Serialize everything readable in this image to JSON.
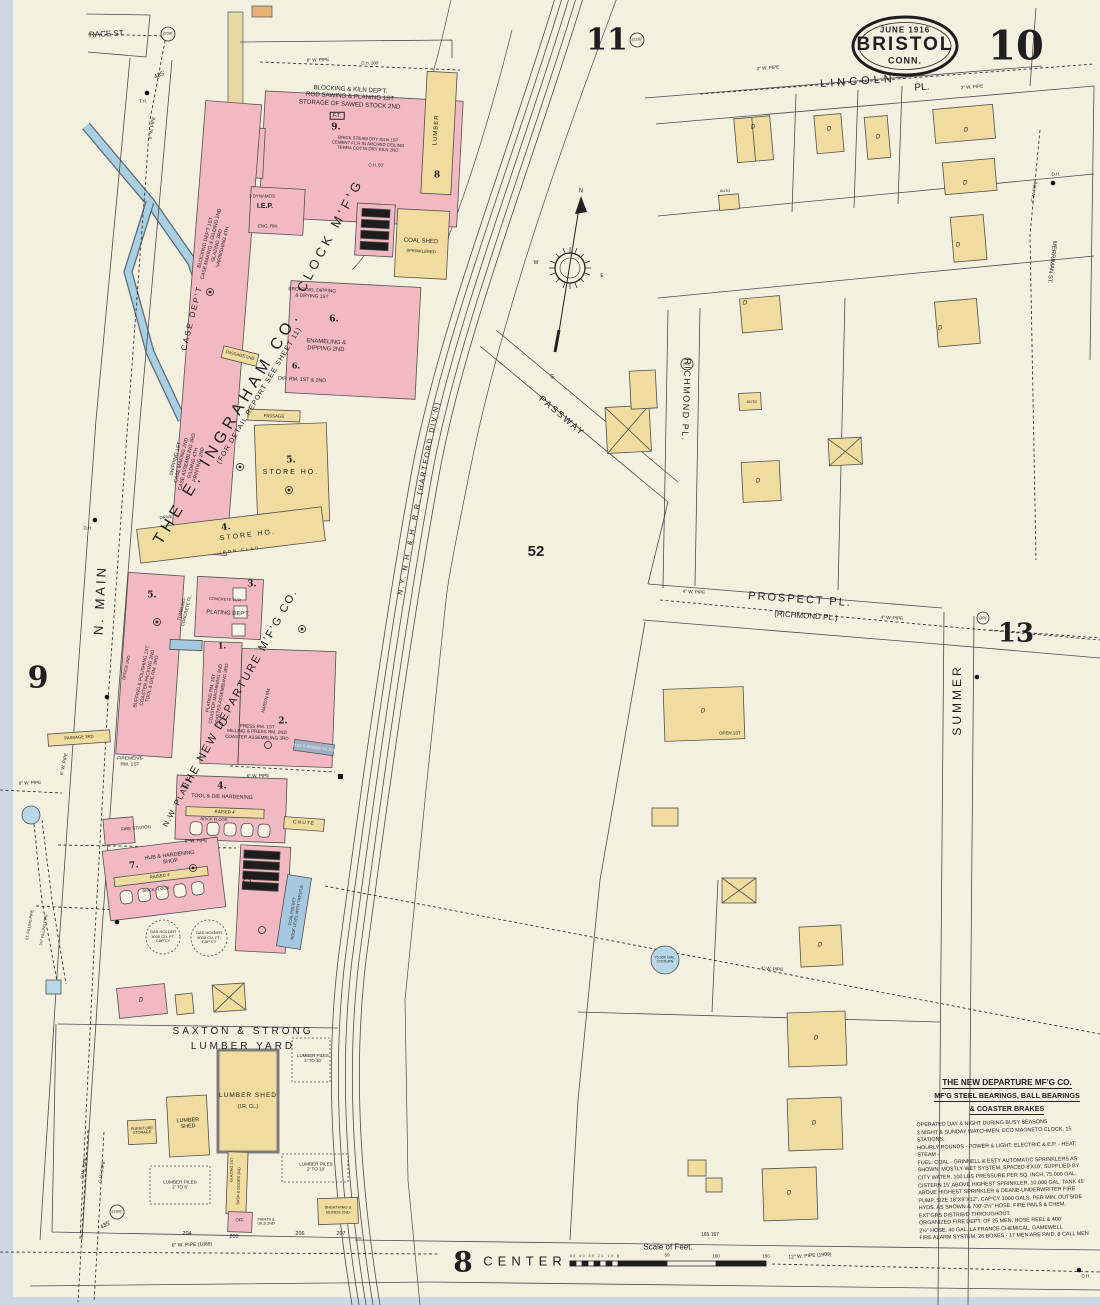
{
  "page": {
    "sheet_number": "10",
    "adjacent_top": "11",
    "adjacent_left": "9",
    "adjacent_right": "13",
    "adjacent_bottom": "8",
    "title_date": "JUNE 1916",
    "title_city": "BRISTOL",
    "title_state": "CONN.",
    "block_number": "52"
  },
  "streets": {
    "race": "RACE ST.",
    "n_main": "N. MAIN",
    "lincoln": "LINCOLN",
    "lincoln_pl": "PL.",
    "richmond": "RICHMOND PL.",
    "prospect": "PROSPECT PL.",
    "prospect_alt": "(RICHMOND PL.)",
    "summer": "SUMMER",
    "passway": "PASSWAY",
    "center": "CENTER",
    "merriman": "MERRIMAN ST.",
    "railroad": "N.Y. N.H. & H. R.R. (HARTFORD DIV'N)"
  },
  "ingraham": {
    "company": "THE E. INGRAHAM CO.",
    "company_sub": "(FOR DETAIL REPORT SEE SHEET 11)",
    "clock_mfg": "CLOCK M'F'G",
    "blocking_kiln": "BLOCKING & KILN DEP'T.\nROD SAWING & PLANING 1ST\nSTORAGE OF SAWED STOCK 2ND",
    "ft": "F.T.",
    "num_9": "9.",
    "kiln_note": "BRICK STEAM DRY KILN 1ST\nCEMENT FL'R IN ARCHED CEILING\nTERRA COTTA DRY KILN 2ND",
    "case_dept": "CASE DEP'T",
    "blocking_stack": "BLOCKING DEP'T 1ST\nCASE MAKING & GILDING 2ND\nGLAZING 3RD\nVARNISHING 4TH",
    "shipping_stack": "SHIPPING 1ST\nCASE MAKING 2ND\nCASE ASSEMBLING 3RD\nGILDING 4TH\nPRINTING 2ND",
    "dynamos": "3 DYNAMOS",
    "iep": "I.E.P.",
    "eng_rm": "ENG. RM.",
    "bronzing": "BRONZING, DIPPING\n& DRYING 1ST",
    "enameling": "ENAMELING &\nDIPPING 2ND",
    "dip_rm": "DIP. RM. 1ST & 2ND",
    "num_6a": "6.",
    "num_6b": "6.",
    "coal_shed": "COAL SHED",
    "sprinklered": "SPRINKLERED",
    "lumber": "LUMBER",
    "num_8": "8",
    "passage": "PASSAGE",
    "passage_2": "PASSAGE 2ND",
    "passage_3": "PASSAGE 3RD",
    "store5_num": "5.",
    "store5": "STORE HO.",
    "store4_num": "4.",
    "store4": "STORE HO.",
    "iron_clad": "IRON CLAD",
    "drive": "DRIVE"
  },
  "departure": {
    "company": "THE NEW DEPARTURE M'F'G CO.",
    "plant": "N.W. PLANT",
    "num_5": "5.",
    "buffing_stack": "BUFFING & POLISHING 1ST\nCOASTER PACKING 2ND\nTOOL & DIE RM. 3RD",
    "office": "OFFICE 2ND",
    "firemens": "FIREMEN'S\nRM. 1ST",
    "num_3": "3.",
    "plating_dept": "PLATING DEP'T.",
    "concrete": "CONCRETE FL'R",
    "tumbling": "TUMBLING\nCONCRETE FL.",
    "num_1": "1.",
    "plating_stack": "PLATING RM. 1ST\nCOASTER MACHINING 2ND\nCOASTER ASSEMBLING 3RD",
    "num_2": "2.",
    "press_stack": "PRESS RM. 1ST\nMILLING & PRESS RM. 2ND\nCOASTER ASSEMBLING 3RD",
    "hardn": "HARD'N RM.",
    "bridge": "ELEV'D BRIDGE TO 2ND",
    "num_4": "4.",
    "tool_die": "TOOL & DIE HARDENING",
    "raised_a": "RAISED 4'",
    "brick_a": "BRICK FLOOR",
    "num_7": "7.",
    "hub": "HUB & HARDENING\nSHOP",
    "raised_b": "RAISED 4'",
    "brick_b": "BRICK FLOOR",
    "chute": "CHUTE",
    "coal_pocket": "COAL POCKET\nROOF LEVEL WITH TRESTLE",
    "fire_station": "FIRE STATION",
    "gas_1": "GAS HOLDER\n3000 CU. FT.\nCAP'CY",
    "gas_2": "GAS HOLDER\n5000 CU. FT.\nCAP'CY",
    "cistern": "75,000 GAL.\nCISTERN"
  },
  "yard": {
    "name_1": "SAXTON  &  STRONG",
    "name_2": "LUMBER   YARD",
    "shed_big": "LUMBER SHED",
    "shed_big_sub": "(I.R. CL.)",
    "shed_small": "LUMBER\nSHED",
    "furniture": "FURNITURE\nSTORAGE",
    "piles_a": "LUMBER PILES\n2' TO 10'",
    "piles_b": "LUMBER PILES\n2' TO 10'",
    "piles_c": "LUMBER PILES\n2' TO 6'",
    "sash": "SASH & DOORS 2ND",
    "glazing": "GLAZING 1ST",
    "office": "OFF.",
    "paints": "PAINTS &\nOILS 2ND",
    "sheathing": "SHEATHING &\nBLINDS 2ND"
  },
  "residential": {
    "dwelling": "D",
    "auto": "AUTO",
    "open": "OPEN 1ST"
  },
  "pipes": {
    "w8": "8\" W. PIPE",
    "w6_top": "6\" W. PIPE",
    "w2_a": "2\" W. PIPE",
    "w2_b": "2\" W. PIPE",
    "w4_mer": "4\" W. PIPE",
    "w4_pros_w": "4\" W. PIPE",
    "w4_pros_e": "4\" W. PIPE",
    "w6_main": "6\" W. PIPE",
    "w6_cross": "6\" W. PIPE",
    "w6_hub": "6\" W. PIPE",
    "w6_b2": "6\" W. PIPE",
    "w4_diag": "4\" W. PIPE",
    "gw_a": "G.W. PIPE",
    "gw_b": "G.W. PIPE",
    "w6_1889": "6\" W. PIPE (1889)",
    "w12_1909": "12\" W. PIPE (1909)",
    "fill_a": "ST. FILLING PIPE",
    "fill_b": "3½\" FILLING PIPE"
  },
  "marks": {
    "d200": "(200)'",
    "d228": "(228)'",
    "d30_a": "(30)'",
    "d30_b": "(30)'",
    "d180": "(180)'",
    "d435_a": "435'",
    "d435_b": "435'",
    "n204": "204",
    "n205": "205",
    "n206": "206",
    "n207": "207",
    "n165": "165   167",
    "th": "T.H.",
    "dh_a": "D.H.",
    "dh_b": "D.H.",
    "dh_c": "D.H.",
    "oh200": "O.H. 200'",
    "oh50": "O.H. 50'"
  },
  "note": {
    "title_1": "THE NEW DEPARTURE MF'G CO.",
    "title_2": "MF'G STEEL BEARINGS, BALL BEARINGS",
    "title_3": "& COASTER BRAKES",
    "body": "OPERATED DAY & NIGHT DURING BUSY SEASONS\n3 NIGHT & SUNDAY WATCHMEN, ECO MAGNETO CLOCK, 15 STATIONS,\nHOURLY ROUNDS - POWER & LIGHT: ELECTRIC & E.P. - HEAT: STEAM -\nFUEL: COAL - GRINNELL & ESTY AUTOMATIC SPRINKLERS AS\nSHOWN, MOSTLY WET SYSTEM, SPACED 8'X10', SUPPLIED BY\nCITY WATER, 100 LBS PRESSURE PER SQ. INCH, 75,000 GAL.\nCISTERN 15' ABOVE HIGHEST SPRINKLER, 10,000 GAL. TANK 45'\nABOVE HIGHEST SPRINKLER & DEANE-UNDERWRITER FIRE\nPUMP, SIZE 18\"X9\"X12\", CAP'CY 1000 GALS. PER MIN. OUTSIDE\nHYDS. AS SHOWN & 700'-2½\" HOSE, FIRE PAILS & CHEM.\nEXT'GRS DISTRIB'D THROUGHOUT.\nORGANIZED FIRE DEPT. OF 25 MEN, HOSE REEL & 400'\n2½\" HOSE, 40 GAL. LA FRANCE CHEMICAL, GAMEWELL\nFIRE ALARM SYSTEM, 26 BOXES - 17 MEN ARE PAID, 8 CALL MEN"
  },
  "scale": {
    "title": "Scale of Feet.",
    "sub": "50 40 30 20 10",
    "z": "0",
    "f50": "50",
    "f100": "100",
    "f150": "150"
  },
  "compass": {
    "n": "N",
    "e": "E",
    "s": "S",
    "w": "W"
  }
}
